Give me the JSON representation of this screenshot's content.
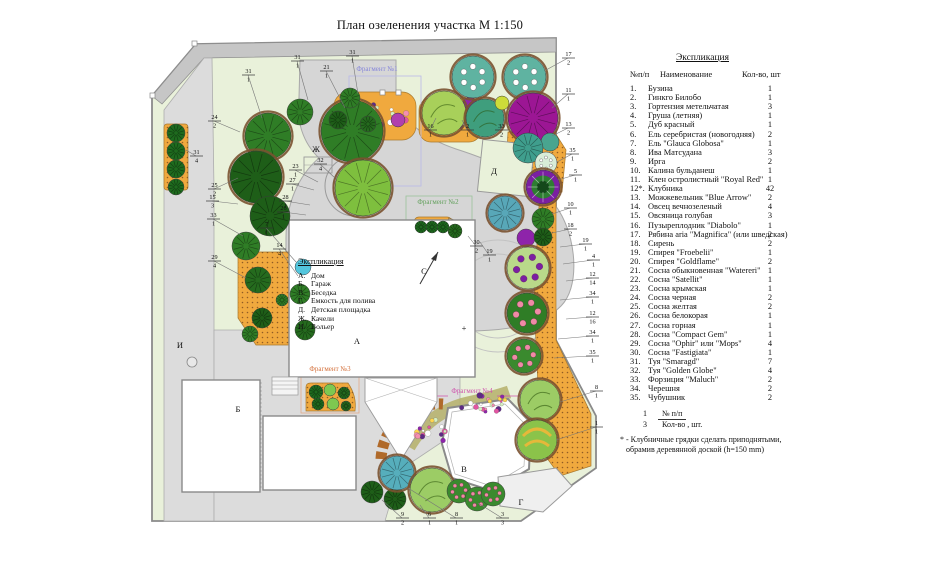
{
  "title": "План озеленения участка  М 1:150",
  "legend": {
    "title": "Экспликация",
    "col_num": "№п/п",
    "col_name": "Наименование",
    "col_qty": "Кол-во, шт",
    "items": [
      {
        "num": "1.",
        "name": "Бузина",
        "qty": "1"
      },
      {
        "num": "2.",
        "name": "Гинкго Билобо",
        "qty": "1"
      },
      {
        "num": "3.",
        "name": "Гортензия метельчатая",
        "qty": "3"
      },
      {
        "num": "4.",
        "name": "Груша (летняя)",
        "qty": "1"
      },
      {
        "num": "5.",
        "name": "Дуб красный",
        "qty": "1"
      },
      {
        "num": "6.",
        "name": "Ель серебристая (новогодняя)",
        "qty": "2"
      },
      {
        "num": "7.",
        "name": "Ель \"Glauca Globosa\"",
        "qty": "1"
      },
      {
        "num": "8.",
        "name": "Ива Матсудана",
        "qty": "3"
      },
      {
        "num": "9.",
        "name": "Ирга",
        "qty": "2"
      },
      {
        "num": "10.",
        "name": "Калина бульданеш",
        "qty": "1"
      },
      {
        "num": "11.",
        "name": "Клен остролистный \"Royal Red\"",
        "qty": "1"
      },
      {
        "num": "12*.",
        "name": "Клубника",
        "qty": "42"
      },
      {
        "num": "13.",
        "name": "Можжевельник \"Blue Arrow\"",
        "qty": "2"
      },
      {
        "num": "14.",
        "name": "Овсец вечнозеленый",
        "qty": "4"
      },
      {
        "num": "15.",
        "name": "Овсяница голубая",
        "qty": "3"
      },
      {
        "num": "16.",
        "name": "Пузыреплодник \"Diabolo\"",
        "qty": "1"
      },
      {
        "num": "17.",
        "name": "Рябина aria \"Magnifica\" (или шведская)",
        "qty": "2"
      },
      {
        "num": "18.",
        "name": "Сирень",
        "qty": "2"
      },
      {
        "num": "19.",
        "name": "Спирея \"Froebelii\"",
        "qty": "1"
      },
      {
        "num": "20.",
        "name": "Спирея \"Goldflame\"",
        "qty": "2"
      },
      {
        "num": "21.",
        "name": "Сосна обыкновенная \"Watereri\"",
        "qty": "1"
      },
      {
        "num": "22.",
        "name": "Сосна \"Satellit\"",
        "qty": "1"
      },
      {
        "num": "23.",
        "name": "Сосна крымская",
        "qty": "1"
      },
      {
        "num": "24.",
        "name": "Сосна черная",
        "qty": "2"
      },
      {
        "num": "25.",
        "name": "Сосна желтая",
        "qty": "2"
      },
      {
        "num": "26.",
        "name": "Сосна белокорая",
        "qty": "1"
      },
      {
        "num": "27.",
        "name": "Сосна горная",
        "qty": "1"
      },
      {
        "num": "28.",
        "name": "Сосна \"Compact Gem\"",
        "qty": "1"
      },
      {
        "num": "29.",
        "name": "Сосна \"Ophir\" или  \"Mops\"",
        "qty": "4"
      },
      {
        "num": "30.",
        "name": "Сосна \"Fastigiata\"",
        "qty": "1"
      },
      {
        "num": "31.",
        "name": "Туя \"Smaragd\"",
        "qty": "7"
      },
      {
        "num": "32.",
        "name": "Туя \"Golden Globe\"",
        "qty": "4"
      },
      {
        "num": "33.",
        "name": "Форзиция \"Maluch\"",
        "qty": "2"
      },
      {
        "num": "34.",
        "name": "Черешня",
        "qty": "2"
      },
      {
        "num": "35.",
        "name": "Чубушник",
        "qty": "2"
      }
    ],
    "key": {
      "top_num": "1",
      "top_label": "№ п/п",
      "bottom_num": "3",
      "bottom_label": "Кол-во , шт."
    },
    "note_line1": "* - Клубничные грядки сделать приподнятыми,",
    "note_line2": "обрамив деревянной доской (h=150 mm)"
  },
  "plan": {
    "inner_legend": {
      "title": "Экспликация",
      "items": [
        {
          "letter": "А.",
          "label": "Дом"
        },
        {
          "letter": "Б.",
          "label": "Гараж"
        },
        {
          "letter": "В.",
          "label": "Беседка"
        },
        {
          "letter": "Г.",
          "label": "Емкость для полива"
        },
        {
          "letter": "Д.",
          "label": "Детская площадка"
        },
        {
          "letter": "Ж.",
          "label": "Качели"
        },
        {
          "letter": "И.",
          "label": "Вольер"
        }
      ]
    },
    "area_labels": [
      [
        "А",
        357,
        344
      ],
      [
        "Б",
        238,
        412
      ],
      [
        "В",
        464,
        472
      ],
      [
        "Г",
        521,
        505
      ],
      [
        "Д",
        494,
        174
      ],
      [
        "Ж",
        316,
        152
      ],
      [
        "И",
        180,
        348
      ],
      [
        "С",
        424,
        274
      ],
      [
        "+",
        464,
        331
      ]
    ],
    "fragments": [
      [
        "Фрагмент №1",
        377,
        71,
        "#8585da"
      ],
      [
        "Фрагмент №2",
        438,
        204,
        "#63a05d"
      ],
      [
        "Фрагмент №3",
        330,
        371,
        "#d4703b"
      ],
      [
        "Фрагмент №4",
        472,
        393,
        "#cf52ad"
      ]
    ],
    "callouts": [
      [
        248,
        74,
        "31",
        "1",
        262,
        118
      ],
      [
        297,
        60,
        "31",
        "1",
        308,
        100
      ],
      [
        352,
        55,
        "31",
        "1",
        358,
        94
      ],
      [
        326,
        70,
        "21",
        "1",
        345,
        108
      ],
      [
        568,
        57,
        "17",
        "2",
        546,
        70
      ],
      [
        568,
        93,
        "11",
        "1",
        552,
        108
      ],
      [
        568,
        127,
        "13",
        "2",
        552,
        136
      ],
      [
        572,
        153,
        "35",
        "1",
        557,
        162
      ],
      [
        575,
        174,
        "5",
        "1",
        558,
        180
      ],
      [
        570,
        207,
        "10",
        "1",
        552,
        214
      ],
      [
        570,
        228,
        "18",
        "2",
        552,
        233
      ],
      [
        585,
        243,
        "19",
        "1",
        560,
        247
      ],
      [
        593,
        259,
        "4",
        "1",
        563,
        264
      ],
      [
        592,
        277,
        "12",
        "14",
        566,
        281
      ],
      [
        592,
        296,
        "34",
        "1",
        560,
        300
      ],
      [
        592,
        316,
        "12",
        "16",
        566,
        319
      ],
      [
        592,
        335,
        "34",
        "1",
        558,
        339
      ],
      [
        592,
        355,
        "35",
        "1",
        554,
        358
      ],
      [
        214,
        120,
        "24",
        "2",
        240,
        132
      ],
      [
        196,
        155,
        "31",
        "4",
        186,
        150
      ],
      [
        214,
        188,
        "25",
        "2",
        238,
        178
      ],
      [
        212,
        200,
        "15",
        "3",
        238,
        204
      ],
      [
        213,
        218,
        "33",
        "1",
        243,
        236
      ],
      [
        214,
        260,
        "29",
        "4",
        246,
        278
      ],
      [
        266,
        227,
        "7",
        "1",
        296,
        262
      ],
      [
        279,
        248,
        "14",
        "4",
        298,
        276
      ],
      [
        295,
        169,
        "23",
        "1",
        318,
        182
      ],
      [
        292,
        183,
        "27",
        "1",
        314,
        190
      ],
      [
        285,
        200,
        "28",
        "1",
        310,
        205
      ],
      [
        283,
        211,
        "26",
        "1",
        306,
        215
      ],
      [
        320,
        163,
        "32",
        "4",
        335,
        178
      ],
      [
        430,
        129,
        "16",
        "1",
        436,
        118
      ],
      [
        467,
        129,
        "2",
        "1",
        462,
        120
      ],
      [
        501,
        129,
        "33",
        "2",
        505,
        118
      ],
      [
        476,
        245,
        "30",
        "2",
        468,
        236
      ],
      [
        489,
        254,
        "19",
        "1",
        480,
        242
      ],
      [
        402,
        517,
        "9",
        "2",
        382,
        500
      ],
      [
        429,
        517,
        "6",
        "1",
        420,
        505
      ],
      [
        456,
        517,
        "8",
        "1",
        408,
        488
      ],
      [
        502,
        517,
        "3",
        "3",
        478,
        503
      ],
      [
        596,
        390,
        "8",
        "1",
        560,
        402
      ],
      [
        596,
        426,
        "1",
        "1",
        556,
        440
      ]
    ],
    "trees": [
      [
        268,
        136,
        23,
        "sp",
        "#2f7d26",
        1
      ],
      [
        256,
        177,
        26,
        "sp",
        "#1e5e18",
        1
      ],
      [
        300,
        112,
        13,
        "sp",
        "#2f7d26",
        0
      ],
      [
        352,
        131,
        31,
        "sp",
        "#2f7d26",
        1
      ],
      [
        363,
        188,
        28,
        "sp",
        "#7ebf3e",
        1
      ],
      [
        270,
        216,
        20,
        "sp",
        "#1e5e18",
        0
      ],
      [
        246,
        246,
        14,
        "sp",
        "#2f7d26",
        0
      ],
      [
        176,
        133,
        9,
        "sp",
        "#1e6b1e",
        0
      ],
      [
        176,
        151,
        9,
        "sp",
        "#1e6b1e",
        0
      ],
      [
        176,
        169,
        9,
        "sp",
        "#1e6b1e",
        0
      ],
      [
        176,
        187,
        8,
        "sp",
        "#1e6b1e",
        0
      ],
      [
        258,
        280,
        13,
        "sp",
        "#256b1e",
        0
      ],
      [
        300,
        294,
        10,
        "sp",
        "#2f7d26",
        0
      ],
      [
        262,
        318,
        10,
        "sp",
        "#1e5e18",
        0
      ],
      [
        250,
        334,
        8,
        "sp",
        "#2f7d26",
        0
      ],
      [
        305,
        330,
        10,
        "sp",
        "#256b1e",
        0
      ],
      [
        282,
        300,
        6,
        "sp",
        "#2f7d26",
        0
      ],
      [
        303,
        267,
        8,
        "pn",
        "#53c6dd",
        0
      ],
      [
        350,
        98,
        10,
        "sp",
        "#2f7d26",
        0
      ],
      [
        338,
        120,
        9,
        "sp",
        "#1e5e18",
        0
      ],
      [
        368,
        124,
        8,
        "sp",
        "#256b1e",
        0
      ],
      [
        398,
        120,
        7,
        "pn",
        "#b13fae",
        0
      ],
      [
        432,
        112,
        9,
        "sp",
        "#2f7d26",
        0
      ],
      [
        452,
        122,
        8,
        "sp",
        "#256b1e",
        0
      ],
      [
        470,
        104,
        7,
        "pn",
        "#8e24aa",
        0
      ],
      [
        473,
        77,
        21,
        "tl",
        "#5fb3a1",
        1
      ],
      [
        525,
        77,
        21,
        "tl",
        "#5fb3a1",
        1
      ],
      [
        444,
        113,
        22,
        "bl",
        "#a8d05a",
        1
      ],
      [
        485,
        118,
        19,
        "bl",
        "#3f9e7d",
        1
      ],
      [
        502,
        103,
        7,
        "pn",
        "#cddc39",
        0
      ],
      [
        524,
        103,
        7,
        "pn",
        "#d4c428",
        0
      ],
      [
        533,
        118,
        25,
        "sp",
        "#9c1694",
        1
      ],
      [
        550,
        142,
        9,
        "pn",
        "#49a58f",
        0
      ],
      [
        528,
        148,
        15,
        "sp",
        "#3f9e8d",
        0
      ],
      [
        546,
        163,
        11,
        "wf",
        "#d8ecd8",
        0
      ],
      [
        543,
        187,
        17,
        "cb",
        "#7b1fa2",
        1
      ],
      [
        543,
        219,
        11,
        "sp",
        "#2f7d26",
        0
      ],
      [
        526,
        238,
        9,
        "pn",
        "#8e24aa",
        0
      ],
      [
        543,
        237,
        9,
        "sp",
        "#1e5e18",
        0
      ],
      [
        505,
        213,
        17,
        "sp",
        "#58a7b8",
        1
      ],
      [
        528,
        268,
        21,
        "pl",
        "#b9d98a",
        1
      ],
      [
        527,
        313,
        20,
        "pk",
        "#2f7d26",
        1
      ],
      [
        524,
        356,
        17,
        "pk",
        "#3a8a2e",
        1
      ],
      [
        540,
        400,
        20,
        "bl",
        "#9ccc65",
        1
      ],
      [
        537,
        440,
        20,
        "st",
        "#8bc34a",
        1
      ],
      [
        372,
        492,
        11,
        "sp",
        "#1e5e18",
        0
      ],
      [
        395,
        499,
        11,
        "sp",
        "#1e5e18",
        0
      ],
      [
        397,
        473,
        17,
        "sp",
        "#56aebc",
        1
      ],
      [
        432,
        490,
        22,
        "bl",
        "#9ccc65",
        1
      ],
      [
        459,
        491,
        12,
        "pk",
        "#3a8a2e",
        0
      ],
      [
        477,
        499,
        12,
        "pk",
        "#3a8a2e",
        0
      ],
      [
        493,
        494,
        12,
        "pk",
        "#3a8a2e",
        0
      ],
      [
        421,
        227,
        6,
        "sp",
        "#1e6b1e",
        0
      ],
      [
        432,
        227,
        6,
        "sp",
        "#1e6b1e",
        0
      ],
      [
        443,
        227,
        6,
        "sp",
        "#1e6b1e",
        0
      ],
      [
        455,
        231,
        7,
        "sp",
        "#256b1e",
        0
      ],
      [
        316,
        392,
        7,
        "sp",
        "#1e6b1e",
        0
      ],
      [
        330,
        390,
        6,
        "pn",
        "#7ec850",
        0
      ],
      [
        344,
        393,
        6,
        "sp",
        "#256b1e",
        0
      ],
      [
        318,
        404,
        6,
        "sp",
        "#1e6b1e",
        0
      ],
      [
        333,
        404,
        6,
        "pn",
        "#7ec850",
        0
      ],
      [
        346,
        406,
        5,
        "sp",
        "#256b1e",
        0
      ]
    ],
    "flower_fields": [
      [
        374,
        116,
        34,
        14,
        30
      ],
      [
        449,
        118,
        25,
        12,
        22
      ],
      [
        432,
        432,
        16,
        13,
        16
      ],
      [
        483,
        403,
        26,
        10,
        22
      ]
    ],
    "palette": [
      "#e255a2",
      "#ffffff",
      "#8e24aa",
      "#ffd54f",
      "#f48fb1",
      "#5e2a84",
      "#d7efc2"
    ]
  },
  "colors": {
    "lawn": "#e9f1da",
    "road": "#c6c6c6",
    "pave": "#dcdcdc",
    "patio": "#d6d6d6",
    "bed": "#f0a93e",
    "bed_dot": "#7a4a1e",
    "leader": "#777777",
    "fence": "#8a8a8a"
  }
}
